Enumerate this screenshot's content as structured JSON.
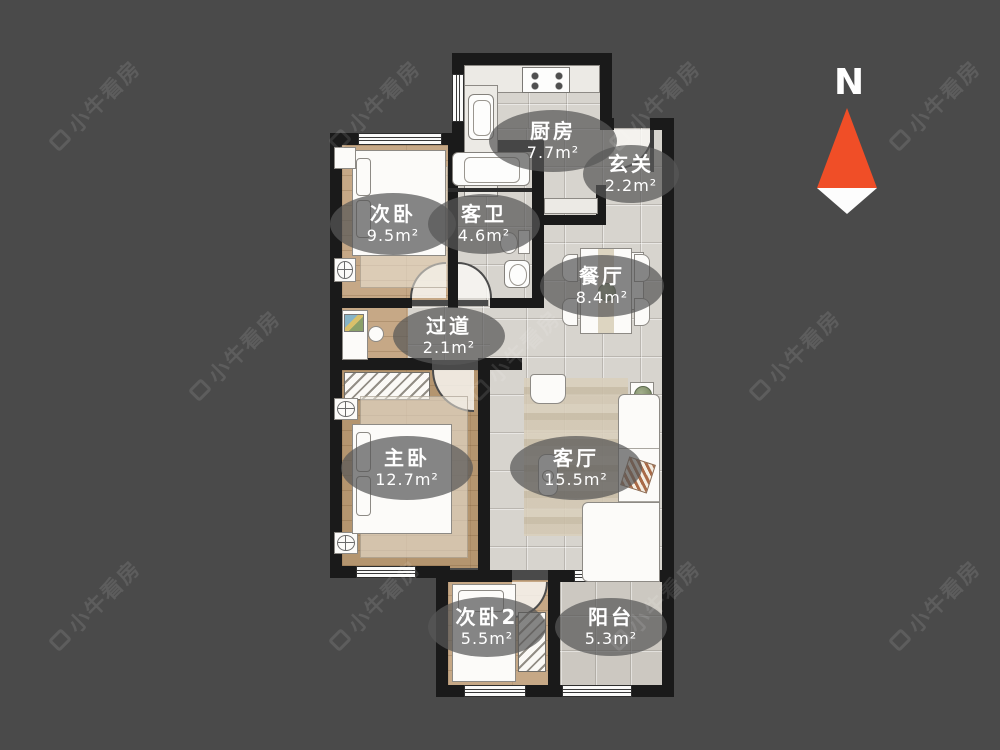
{
  "canvas": {
    "background_color": "#4a4a4a"
  },
  "watermark": {
    "text": "小牛看房"
  },
  "compass": {
    "label": "N",
    "arrow_color": "#f04e27"
  },
  "rooms": [
    {
      "key": "kitchen",
      "name": "厨房",
      "area": "7.7m²"
    },
    {
      "key": "hallway",
      "name": "玄关",
      "area": "2.2m²"
    },
    {
      "key": "second-bedroom",
      "name": "次卧",
      "area": "9.5m²"
    },
    {
      "key": "guest-bathroom",
      "name": "客卫",
      "area": "4.6m²"
    },
    {
      "key": "dining-room",
      "name": "餐厅",
      "area": "8.4m²"
    },
    {
      "key": "corridor",
      "name": "过道",
      "area": "2.1m²"
    },
    {
      "key": "master-bedroom",
      "name": "主卧",
      "area": "12.7m²"
    },
    {
      "key": "living-room",
      "name": "客厅",
      "area": "15.5m²"
    },
    {
      "key": "third-bedroom",
      "name": "次卧2",
      "area": "5.5m²"
    },
    {
      "key": "balcony",
      "name": "阳台",
      "area": "5.3m²"
    }
  ]
}
